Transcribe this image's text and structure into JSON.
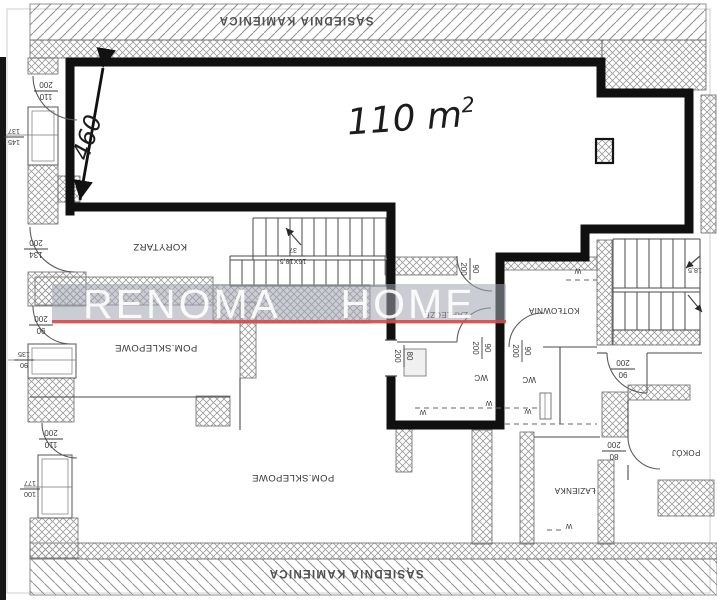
{
  "plan": {
    "neighbors": {
      "top": "SĄSIEDNIA KAMIENICA",
      "bottom": "SĄSIEDNIA KAMIENICA"
    },
    "area_label": {
      "value": "110 m",
      "sup": "2"
    },
    "length_dim": "460",
    "rooms": {
      "korytarz": "KORYTARZ",
      "pom_sklepowe_top": "POM.SKLEPOWE",
      "pom_sklepowe_bottom": "POM.SKLEPOWE",
      "zaplecze": "ZAPLECZE",
      "kotlownia": "KOTŁOWNIA",
      "wc_inner": "WC",
      "wc_kotlownia": "WC",
      "lazienka": "ŁAZIENKA",
      "pokoj": "POKÓJ"
    },
    "stairs": {
      "main_top": "16X18,5",
      "main_bottom": "37",
      "right": "18,5"
    },
    "vent": "W",
    "door_dims": [
      {
        "num": "110",
        "den": "200"
      },
      {
        "num": "134",
        "den": "200"
      },
      {
        "num": "90",
        "den": "200"
      },
      {
        "num": "110",
        "den": "200"
      },
      {
        "num": "90",
        "den": "200"
      },
      {
        "num": "90",
        "den": "200"
      },
      {
        "num": "90",
        "den": "200"
      },
      {
        "num": "80",
        "den": "200"
      },
      {
        "num": "90",
        "den": "200"
      },
      {
        "num": "80",
        "den": "200"
      }
    ],
    "window_dims": [
      {
        "a": "145",
        "b": "137"
      },
      {
        "a": "90",
        "b": "135"
      },
      {
        "a": "100",
        "b": "177"
      }
    ]
  },
  "watermark": {
    "left": "RENOMA",
    "right": "HOME",
    "accent_red": "#d84343",
    "box_gray": "#9ea4ae"
  }
}
